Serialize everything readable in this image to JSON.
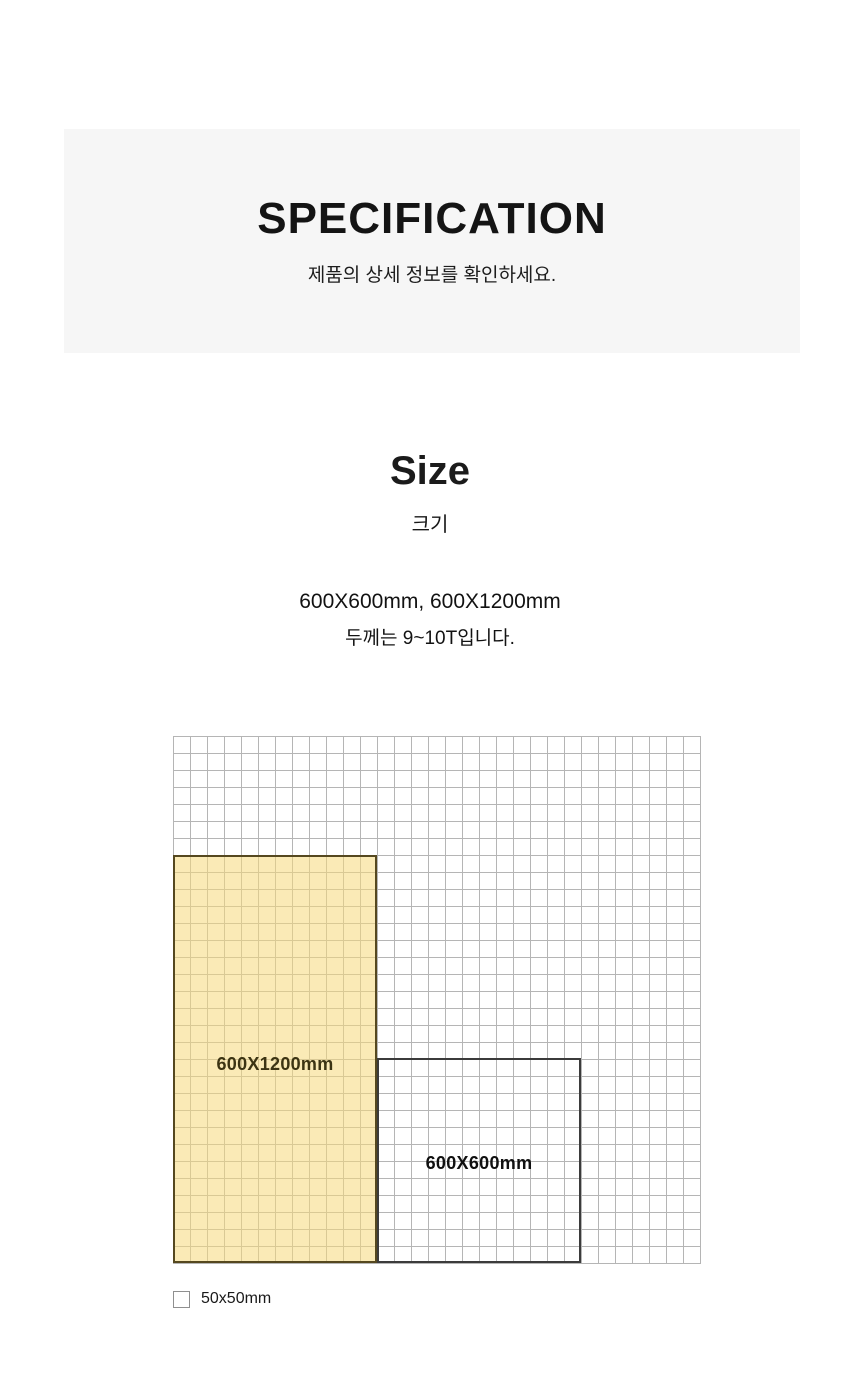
{
  "header": {
    "title": "SPECIFICATION",
    "subtitle": "제품의 상세 정보를 확인하세요."
  },
  "size": {
    "title": "Size",
    "subtitle_korean": "크기",
    "dimensions_line": "600X600mm, 600X1200mm",
    "thickness_line": "두께는 9~10T입니다."
  },
  "diagram": {
    "rects": [
      {
        "label": "600X1200mm",
        "highlighted": true
      },
      {
        "label": "600X600mm",
        "highlighted": false
      }
    ],
    "legend_label": "50x50mm",
    "cell_size_mm": 50
  },
  "colors": {
    "band_bg": "#f6f6f6",
    "grid_line": "#b5b5b5",
    "highlight_fill": "rgba(246,216,122,0.55)",
    "highlight_border": "#55481f",
    "highlight_text": "#3c3413",
    "outline_border": "#3b3b3b",
    "text_dark": "#171717"
  }
}
